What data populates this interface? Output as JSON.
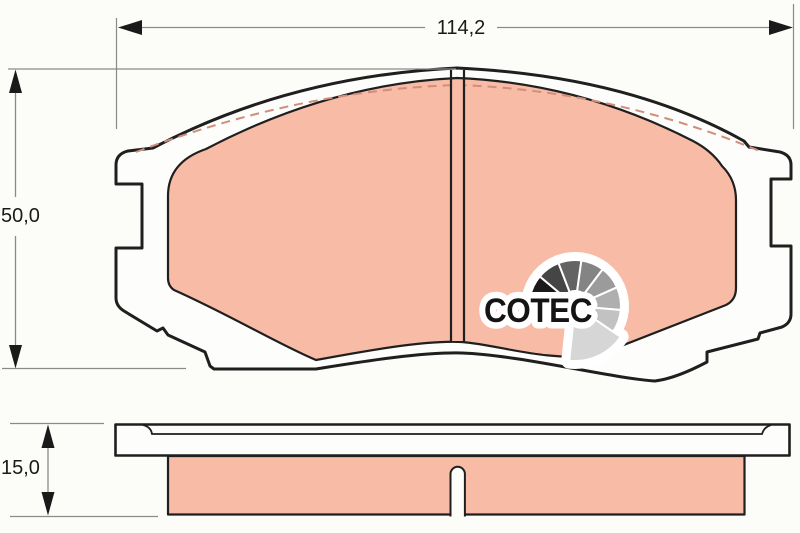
{
  "drawing": {
    "type": "brake-pad technical drawing, front view and side view",
    "dimensions": {
      "width_label": "114,2",
      "height_label": "50,0",
      "thickness_label": "15,0"
    },
    "logo": {
      "text": "COTEC",
      "gauge": {
        "cx": 575,
        "cy": 306,
        "inner_radius": 15,
        "outer_radius": 46,
        "segments": [
          {
            "start": 169,
            "end": 140,
            "color": "#1a1a1a"
          },
          {
            "start": 140,
            "end": 111,
            "color": "#454545"
          },
          {
            "start": 111,
            "end": 82,
            "color": "#636363"
          },
          {
            "start": 82,
            "end": 53,
            "color": "#848484"
          },
          {
            "start": 53,
            "end": 24,
            "color": "#9b9b9b"
          },
          {
            "start": 24,
            "end": -5,
            "color": "#afafaf"
          },
          {
            "start": -5,
            "end": -34,
            "color": "#c2c2c2"
          },
          {
            "start": -34,
            "end": -96,
            "color": "#d6d6d6",
            "outer": 55
          }
        ]
      }
    },
    "colors": {
      "background": "#fcfcf9",
      "plate_fill": "#fdfdfb",
      "outline": "#1f1f1f",
      "friction": "#f8bba6",
      "chamfer_dash": "#d08e7c",
      "dimension_line": "#8a8a8a",
      "text": "#1a1a1a",
      "logo_text": "#141414"
    }
  }
}
